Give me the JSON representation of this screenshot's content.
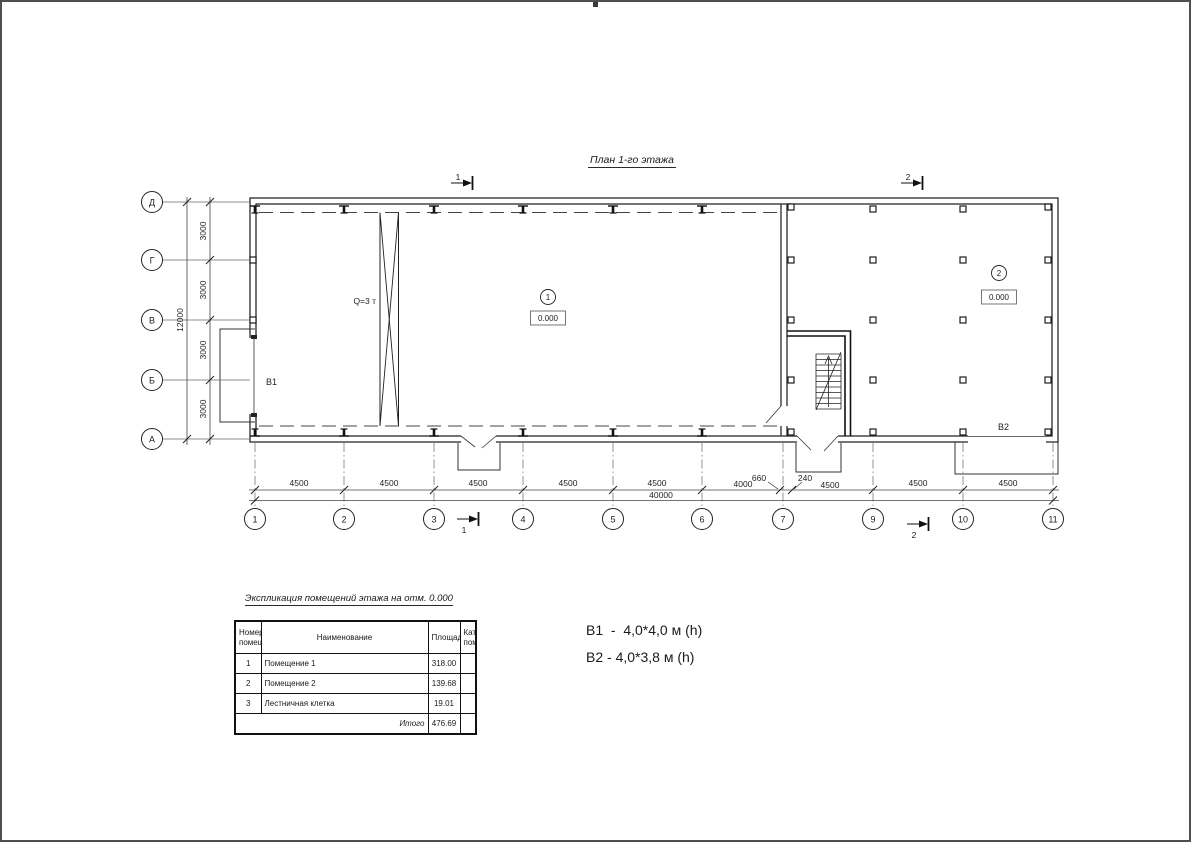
{
  "page": {
    "title": "План 1-го этажа"
  },
  "axes": {
    "rows": [
      "Д",
      "Г",
      "В",
      "Б",
      "А"
    ],
    "cols": [
      "1",
      "2",
      "3",
      "4",
      "5",
      "6",
      "7",
      "9",
      "10",
      "11"
    ]
  },
  "dims": {
    "v_segments": [
      "3000",
      "3000",
      "3000",
      "3000"
    ],
    "v_total": "12000",
    "h_segments": [
      "4500",
      "4500",
      "4500",
      "4500",
      "4500",
      "4000",
      "660",
      "240",
      "4500",
      "4500",
      "4500"
    ],
    "h_total": "40000"
  },
  "plan": {
    "crane_label": "Q=3 т",
    "room1_number": "1",
    "room1_elevation": "0.000",
    "room2_number": "2",
    "room2_elevation": "0.000",
    "gate1_label": "В1",
    "gate2_label": "В2"
  },
  "sections": {
    "top1": "1",
    "top2": "2",
    "bottom1": "1",
    "bottom2": "2"
  },
  "legend": {
    "b1": "В1  -  4,0*4,0 м (h)",
    "b2": "В2 - 4,0*3,8 м (h)"
  },
  "table": {
    "title": "Экспликация помещений этажа на отм. 0.000",
    "headers": {
      "num": "Номер\nпомещ.",
      "name": "Наименование",
      "area": "Площадь",
      "cat": "Кат.\nпом."
    },
    "rows": [
      {
        "num": "1",
        "name": "Помещение 1",
        "area": "318.00",
        "cat": ""
      },
      {
        "num": "2",
        "name": "Помещение 2",
        "area": "139.68",
        "cat": ""
      },
      {
        "num": "3",
        "name": "Лестничная клетка",
        "area": "19.01",
        "cat": ""
      }
    ],
    "total_label": "Итого",
    "total_value": "476.69"
  }
}
